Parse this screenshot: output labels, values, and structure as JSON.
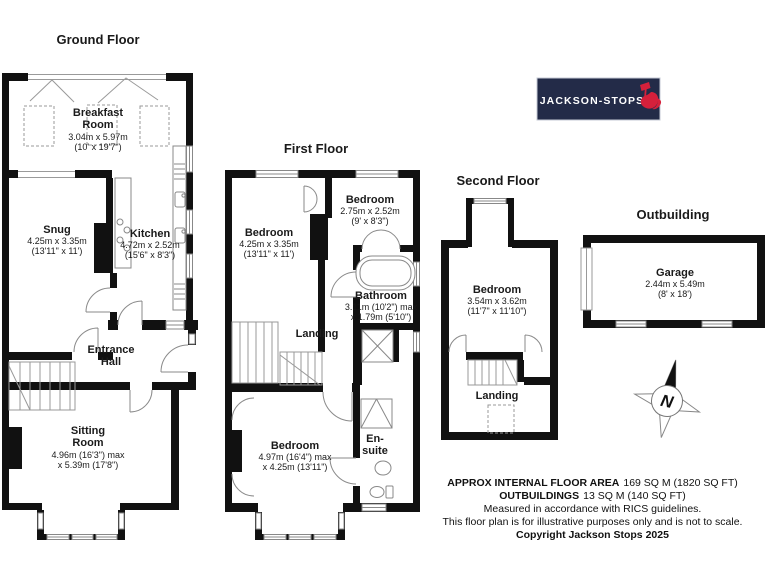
{
  "page": {
    "bg": "#ffffff"
  },
  "branding": {
    "logo_text": "JACKSON-STOPS",
    "logo_bg": "#232b48",
    "logo_accent": "#d5203b"
  },
  "floors": {
    "ground": {
      "title": "Ground Floor",
      "rooms": {
        "breakfast": {
          "name": "Breakfast Room",
          "dims1": "3.04m x 5.97m",
          "dims2": "(10' x 19'7\")"
        },
        "snug": {
          "name": "Snug",
          "dims1": "4.25m x 3.35m",
          "dims2": "(13'11\" x 11')"
        },
        "kitchen": {
          "name": "Kitchen",
          "dims1": "4.72m x 2.52m",
          "dims2": "(15'6\" x 8'3\")"
        },
        "entrance_hall": {
          "name": "Entrance Hall"
        },
        "sitting": {
          "name": "Sitting Room",
          "dims1": "4.96m (16'3\") max",
          "dims2": "x 5.39m (17'8\")"
        }
      }
    },
    "first": {
      "title": "First Floor",
      "rooms": {
        "bedroom1": {
          "name": "Bedroom",
          "dims1": "4.25m x 3.35m",
          "dims2": "(13'11\" x 11')"
        },
        "bedroom2": {
          "name": "Bedroom",
          "dims1": "2.75m x 2.52m",
          "dims2": "(9' x 8'3\")"
        },
        "bathroom": {
          "name": "Bathroom",
          "dims1": "3.11m (10'2\") max",
          "dims2": "x 1.79m (5'10\")"
        },
        "landing": {
          "name": "Landing"
        },
        "bedroom3": {
          "name": "Bedroom",
          "dims1": "4.97m (16'4\") max",
          "dims2": "x 4.25m (13'11\")"
        },
        "ensuite": {
          "name": "En-suite"
        }
      }
    },
    "second": {
      "title": "Second Floor",
      "rooms": {
        "bedroom": {
          "name": "Bedroom",
          "dims1": "3.54m x 3.62m",
          "dims2": "(11'7\" x 11'10\")"
        },
        "landing": {
          "name": "Landing"
        }
      }
    },
    "outbuilding": {
      "title": "Outbuilding",
      "rooms": {
        "garage": {
          "name": "Garage",
          "dims1": "2.44m x 5.49m",
          "dims2": "(8' x 18')"
        }
      }
    }
  },
  "compass": {
    "label": "N"
  },
  "footer": {
    "line1_label": "APPROX INTERNAL FLOOR AREA",
    "line1_value": "169 SQ M (1820 SQ FT)",
    "line2_label": "OUTBUILDINGS",
    "line2_value": "13 SQ M (140 SQ FT)",
    "line3": "Measured in accordance with RICS guidelines.",
    "line4": "This floor plan is for illustrative purposes only and is not to scale.",
    "line5": "Copyright Jackson Stops 2025"
  }
}
